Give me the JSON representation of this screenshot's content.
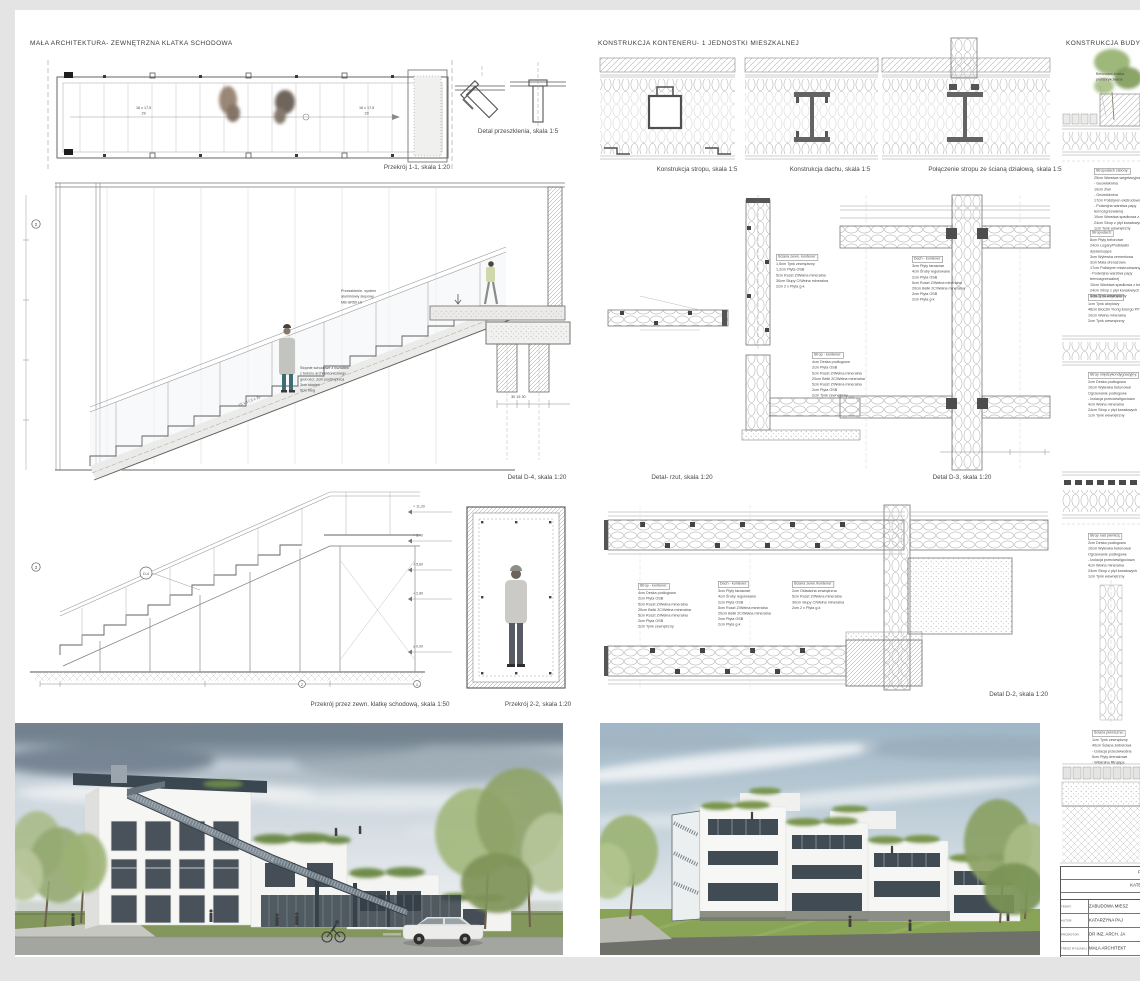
{
  "titles": {
    "left": "MAŁA ARCHITEKTURA- ZEWNĘTRZNA KLATKA SCHODOWA",
    "middle": "KONSTRUKCJA KONTENERU- 1 JEDNOSTKI MIESZKALNEJ",
    "right": "KONSTRUKCJA BUDYNKU NA"
  },
  "captions": {
    "przekroj_1_1": "Przekrój 1-1, skala 1:20",
    "detal_przeszklenia": "Detal przeszklenia, skala 1:5",
    "konstrukcja_stropu": "Konstrukcja stropu, skala 1:5",
    "konstrukcja_dachu": "Konstrukcja dachu, skala 1:5",
    "polaczenie_stropu": "Połączenie stropu ze ścianą działową, skala 1:5",
    "detal_d4": "Detal D-4, skala 1:20",
    "detal_rzut": "Detal- rzut, skala 1:20",
    "detal_d3": "Detal D-3, skala 1:20",
    "przekroj_klatka": "Przekrój przez zewn. klatkę schodową, skala 1:50",
    "przekroj_2_2": "Przekrój 2-2, skala 1:20",
    "detal_d2": "Detal D-2, skala 1:20"
  },
  "annotations": {
    "glazing": "Przeszklenie- system\naluminiowy słupowy\nMB-SR50 HI",
    "steps": "Stopnie schodowe z kształtek\nz betonu architektonicznego\ngrubości:  2cm podstopnica\n3cm stopień\n5cm bieg",
    "plan_dim": "16 x 17,5\n29",
    "stair_dim": "16 x 17,5 x 29",
    "kostka": "Betonowa kostka\nprefabrykowana",
    "levels": [
      "+ 11,20",
      "+ 8,40",
      "+ 5,60",
      "+ 2,80",
      "± 0,00"
    ],
    "axis_left": "2",
    "axis_right": "1",
    "section_mark": "2",
    "detail_mark": "D-4",
    "footing_dims": "30      15      30"
  },
  "layers": {
    "sciana_kontener": {
      "title": "Ściana zewn. kontener:",
      "body": "1,5cm  Tynk zewnętrzny\n1,2cm  Płyta OSB\n5cm  Ruszt Z/Wełna mineralna\n30cm  Słupy C/Wełna mineralna\n2cm  2 x Płyta g-k"
    },
    "sciana_kontener2": {
      "title": "Ściana zewn./kontener:",
      "body": "2cm  Okładzina zewnętrzna\n5cm  Ruszt Z/Wełna mineralna\n30cm  Słupy C/Wełna mineralna\n2cm  2 x Płyta g-k"
    },
    "strop_kontener": {
      "title": "Strop - kontener:",
      "body": "4cm  Deska podłogowa\n2cm  Płyta OSB\n5cm  Ruszt Z/Wełna mineralna\n20cm  Belki 2C/Wełna mineralna\n5cm  Ruszt Z/Wełna mineralna\n2cm  Płyta OSB\n2cm  Tynk zewnętrzny"
    },
    "dach_kontener": {
      "title": "Dach - kontener:",
      "body": "3cm  Płyty tarasowe\n4cm  Śruby regulowane\n2cm  Płyta OSB\n5cm  Ruszt Z/Wełna mineralna\n20cm  Belki 2C/Wełna mineralna\n2cm  Płyta OSB\n2cm  Płyta g-k"
    },
    "stropodach_zielony": {
      "title": "Stropodach zielony:",
      "body": "25cm  Warstwa wegetacyjna\n-  Geowłóknina\n10cm  Żwir\n-  Geowłóknina\n17cm  Polistyren ekstrudowany\n-  Podwójna warstwa papy\n    termozgrzewalnej\n10cm  Warstwa spadkowa z betonu\n24cm  Strop z płyt kanałowych\n1cm  Tynk wewnętrzny"
    },
    "stropodach": {
      "title": "Stropodach:",
      "body": "8cm  Płyty betonowe\n24cm  Legary/Podkładki\n    dystansujące\n3cm  Wylewka cementowa\n3cm  Mata drenażowa\n17cm  Polistyren ekstrudowany\n-  Podwójna warstwa papy\n    termozgrzewalnej\n10cm  Warstwa spadkowa z betonu\n24cm  Strop z płyt kanałowych\n1cm  Tynk wewnętrzny"
    },
    "sciana_zewnetrzna": {
      "title": "Ściana zewnętrzna:",
      "body": "1cm  Tynk akrylowy\n48cm  Bloczki Ytong Energo PP\n10cm  Wełna mineralna\n2cm  Tynk wewnętrzny"
    },
    "strop_miedzykondygnacyjny": {
      "title": "Strop międzykondygnacyjny:",
      "body": "2cm  Deska podłogowa\n10cm  Wylewka betonowa/\n    Ogrzewanie podłogowe\n-  Izolacja przeciwwilgociowa\n4cm  Wełna mineralna\n24cm  Strop z płyt kanałowych\n1cm  Tynk wewnętrzny"
    },
    "strop_nad_piwnica": {
      "title": "Strop nad piwnicą:",
      "body": "2cm  Deska podłogowa\n10cm  Wylewka betonowa/\n    Ogrzewanie podłogowe\n-  Izolacja przeciwwilgociowa\n4cm  Wełna mineralna\n24cm  Strop z płyt kanałowych\n1cm  Tynk wewnętrzny"
    },
    "sciana_piwniczna": {
      "title": "Ściana piwniczna:",
      "body": "1cm  Tynk zewnętrzny\n40cm  Ściana żelbetowa\n-  Izolacja przeciwwodna\n5cm  Płyty drenażowe\n-  Włóknina filtrująca"
    }
  },
  "titleblock": {
    "header1": "P",
    "header2": "KATE",
    "temat_label": "TEMAT:",
    "temat": "ZABUDOWA MIESZ",
    "autor_label": "AUTOR:",
    "autor": "KATARZYNA PAJ",
    "promotor_label": "PROMOTOR:",
    "promotor": "DR INŻ. ARCH. JA",
    "tresc_label": "TREŚĆ RYSUNKU:",
    "tresc": "MAŁA ARCHITEKT"
  }
}
